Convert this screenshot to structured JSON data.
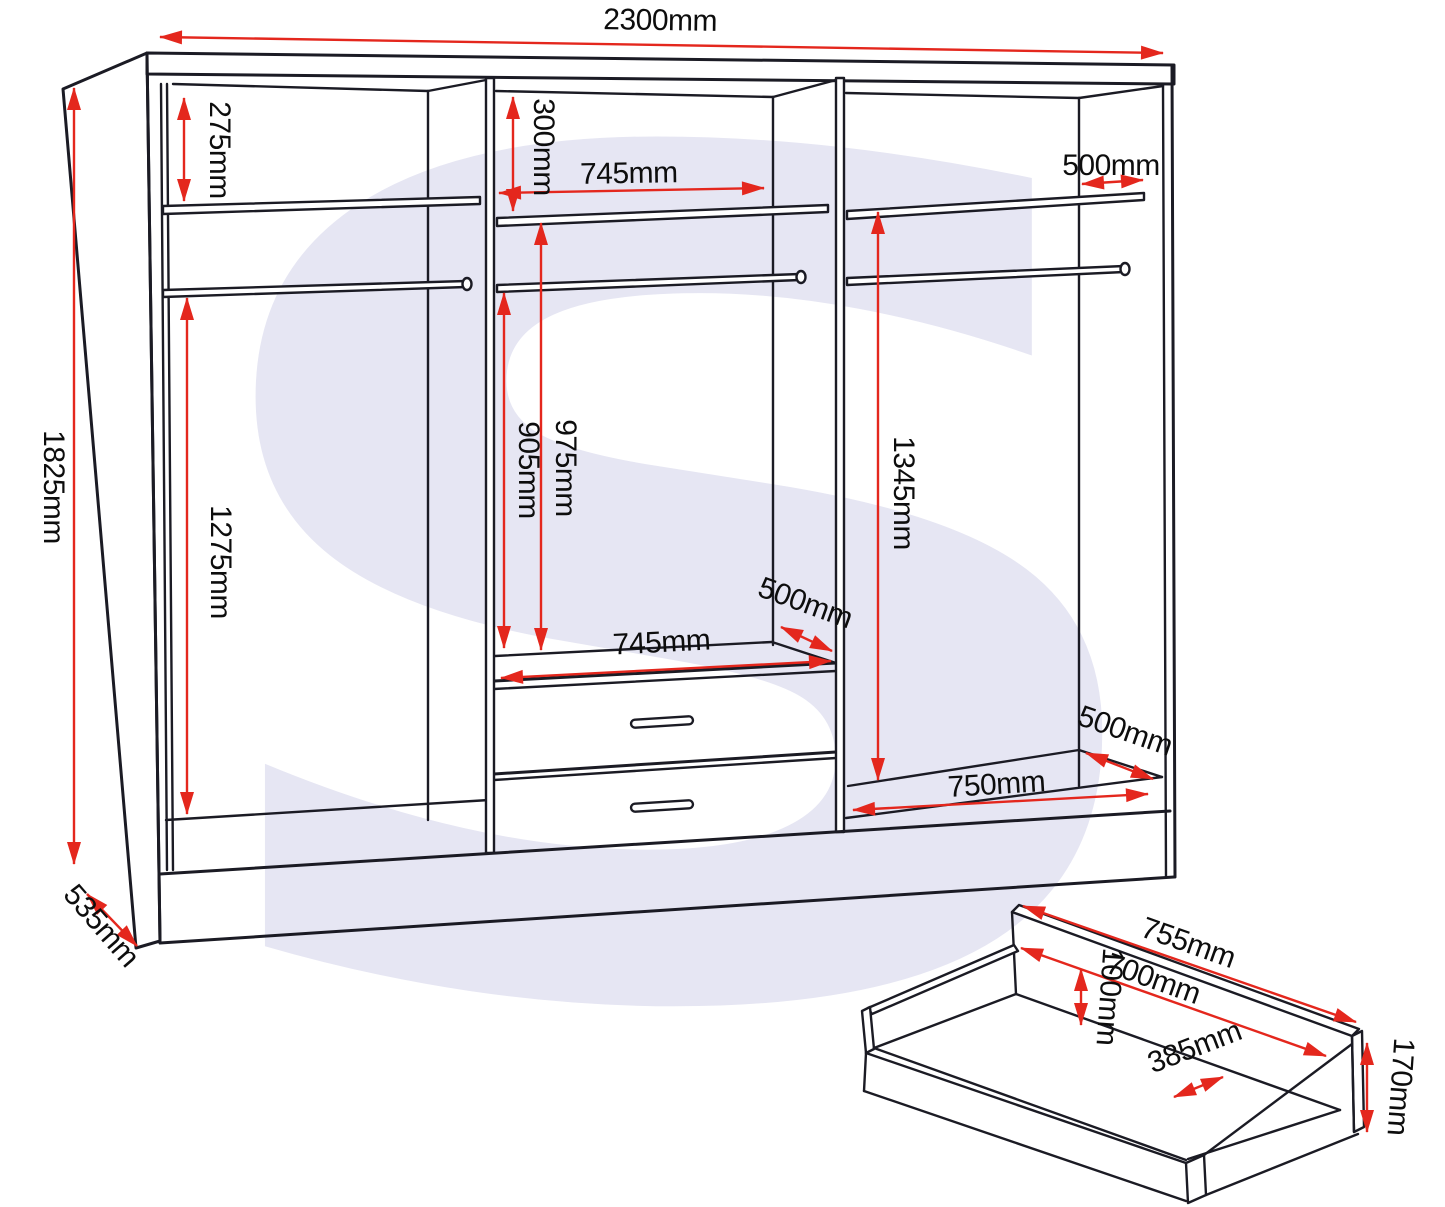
{
  "diagram": {
    "watermark": "S",
    "colors": {
      "dimension_red": "#e4271d",
      "line": "#1b1b24",
      "watermark": "#e6e6f3",
      "background": "#ffffff"
    },
    "wardrobe": {
      "overall": {
        "width": "2300mm",
        "height": "1825mm",
        "depth": "535mm"
      },
      "left_section": {
        "top_shelf_height": "275mm",
        "hanging_height": "1275mm"
      },
      "middle_section": {
        "top_gap": "300mm",
        "shelf_width": "745mm",
        "rail_to_drawers": "905mm",
        "shelf_to_drawers": "975mm",
        "drawer_top_width": "745mm",
        "shelf_depth": "500mm"
      },
      "right_section": {
        "shelf_depth": "500mm",
        "shelf_to_base": "1345mm",
        "base_width": "750mm",
        "base_depth": "500mm"
      }
    },
    "drawer": {
      "back_width": "755mm",
      "inner_width": "700mm",
      "side_height": "100mm",
      "inner_depth": "385mm",
      "front_height": "170mm"
    }
  }
}
